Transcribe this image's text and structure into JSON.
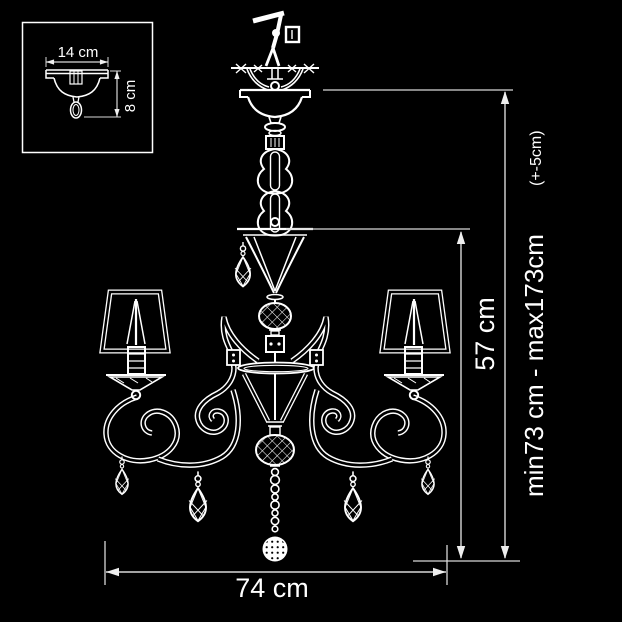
{
  "colors": {
    "background": "#000000",
    "line": "#ffffff",
    "dimension_line": "#d8d8d8"
  },
  "inset": {
    "width_label": "14 cm",
    "height_label": "8 cm"
  },
  "dimensions": {
    "width_label": "74 cm",
    "body_height_label": "57 cm",
    "hanging_height_label": "min73 cm - max173cm",
    "hanging_height_tolerance": "(+-5cm)"
  }
}
